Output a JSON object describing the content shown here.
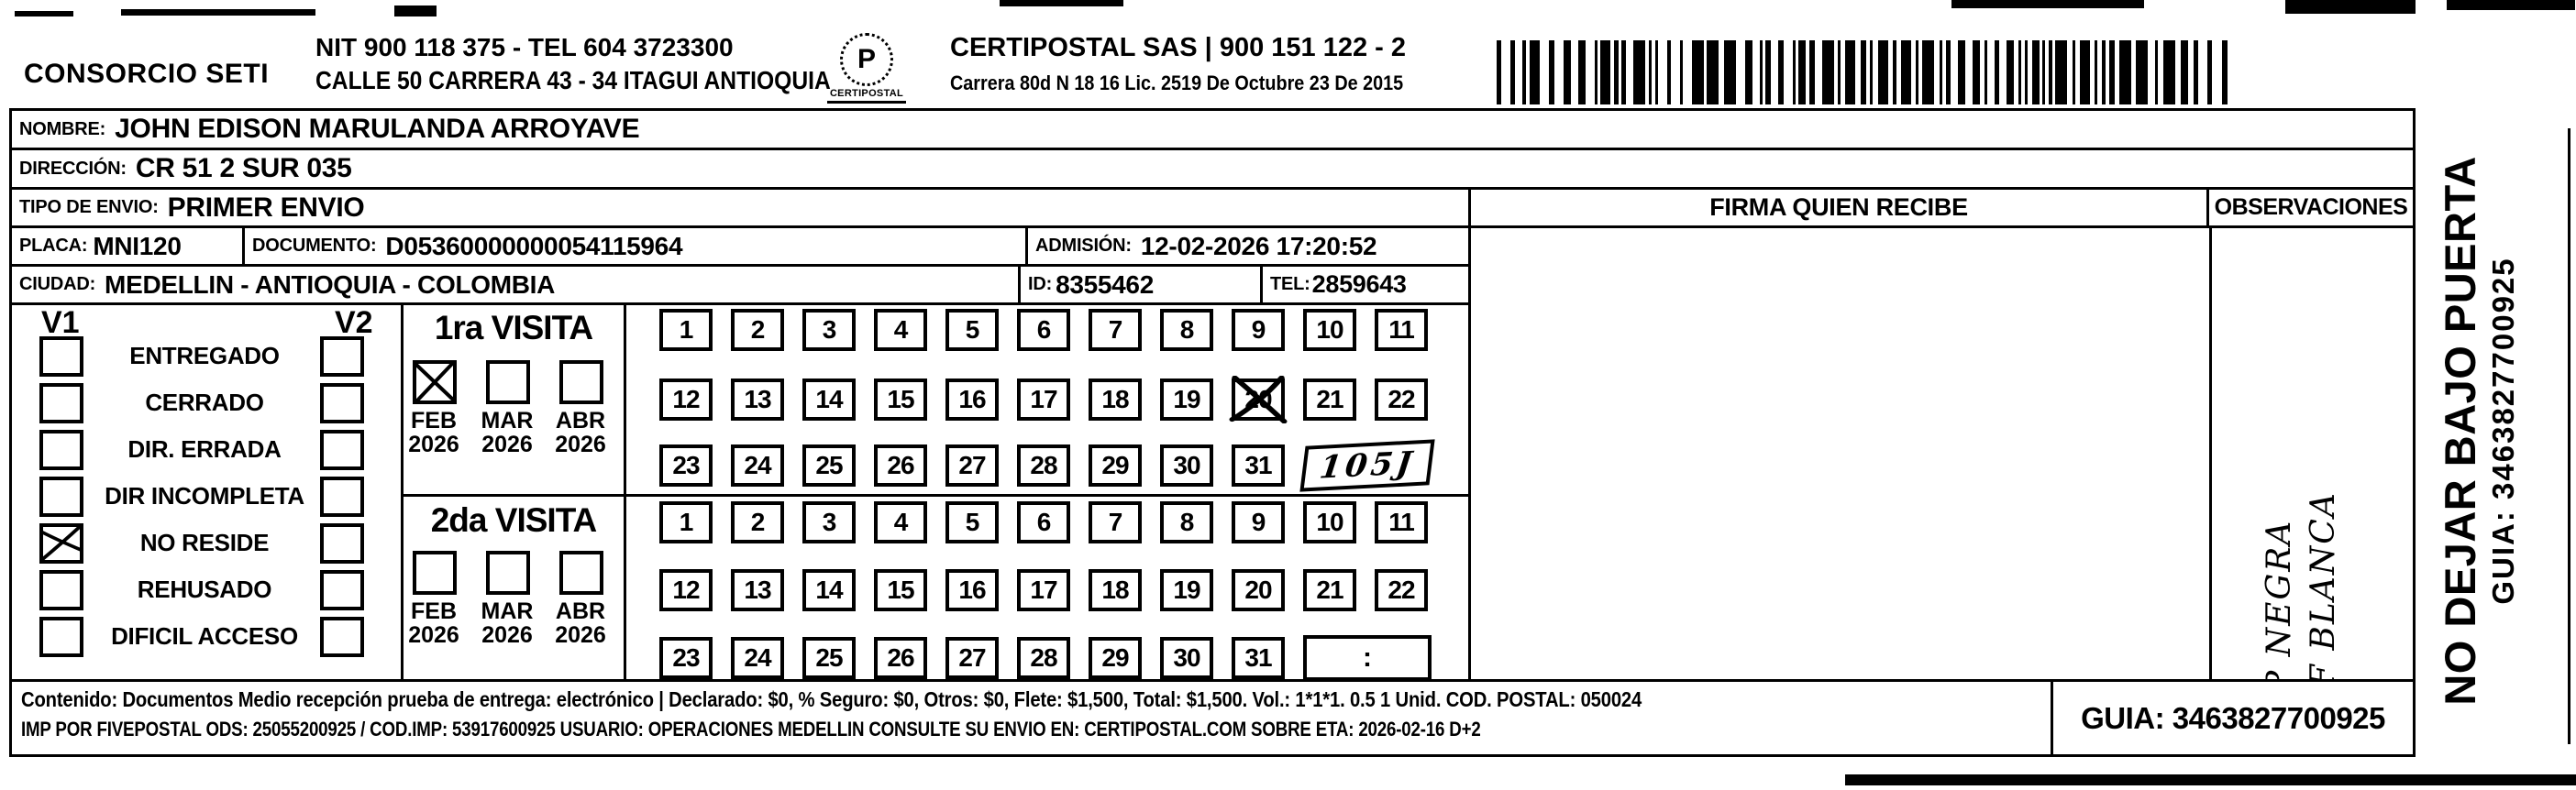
{
  "header": {
    "company": "CONSORCIO SETI",
    "nit_tel": "NIT 900 118 375 - TEL 604 3723300",
    "address": "CALLE 50 CARRERA 43 - 34 ITAGUI ANTIOQUIA",
    "logo": {
      "name": "CERTIPOSTAL",
      "glyph": "P"
    },
    "carrier": "CERTIPOSTAL SAS | 900 151 122 - 2",
    "carrier_address": "Carrera 80d N 18 16  Lic. 2519 De Octubre 23 De 2015"
  },
  "shipment": {
    "nombre_label": "NOMBRE:",
    "nombre": "JOHN EDISON MARULANDA ARROYAVE",
    "direccion_label": "DIRECCIÓN:",
    "direccion": "CR 51 2 SUR 035",
    "tipo_envio_label": "TIPO DE ENVIO:",
    "tipo_envio": "PRIMER ENVIO",
    "placa_label": "PLACA:",
    "placa": "MNI120",
    "documento_label": "DOCUMENTO:",
    "documento": "D05360000000054115964",
    "admision_label": "ADMISIÓN:",
    "admision": "12-02-2026 17:20:52",
    "ciudad_label": "CIUDAD:",
    "ciudad": "MEDELLIN - ANTIOQUIA - COLOMBIA",
    "id_label": "ID:",
    "id": "8355462",
    "tel_label": "TEL:",
    "tel": "2859643"
  },
  "status_panel": {
    "v1": "V1",
    "v2": "V2",
    "options": [
      {
        "label": "ENTREGADO",
        "v1": false,
        "v2": false
      },
      {
        "label": "CERRADO",
        "v1": false,
        "v2": false
      },
      {
        "label": "DIR. ERRADA",
        "v1": false,
        "v2": false
      },
      {
        "label": "DIR INCOMPLETA",
        "v1": false,
        "v2": false
      },
      {
        "label": "NO RESIDE",
        "v1": true,
        "v2": false
      },
      {
        "label": "REHUSADO",
        "v1": false,
        "v2": false
      },
      {
        "label": "DIFICIL ACCESO",
        "v1": false,
        "v2": false
      }
    ]
  },
  "visits": [
    {
      "title": "1ra VISITA",
      "months": [
        {
          "month": "FEB",
          "year": "2026",
          "checked": true
        },
        {
          "month": "MAR",
          "year": "2026",
          "checked": false
        },
        {
          "month": "ABR",
          "year": "2026",
          "checked": false
        }
      ],
      "day_rows": [
        [
          1,
          2,
          3,
          4,
          5,
          6,
          7,
          8,
          9,
          10,
          11
        ],
        [
          12,
          13,
          14,
          15,
          16,
          17,
          18,
          19,
          20,
          21,
          22
        ],
        [
          23,
          24,
          25,
          26,
          27,
          28,
          29,
          30,
          31
        ]
      ],
      "crossed_day": 20,
      "time_box": "105J",
      "time_box_handwritten": true
    },
    {
      "title": "2da VISITA",
      "months": [
        {
          "month": "FEB",
          "year": "2026",
          "checked": false
        },
        {
          "month": "MAR",
          "year": "2026",
          "checked": false
        },
        {
          "month": "ABR",
          "year": "2026",
          "checked": false
        }
      ],
      "day_rows": [
        [
          1,
          2,
          3,
          4,
          5,
          6,
          7,
          8,
          9,
          10,
          11
        ],
        [
          12,
          13,
          14,
          15,
          16,
          17,
          18,
          19,
          20,
          21,
          22
        ],
        [
          23,
          24,
          25,
          26,
          27,
          28,
          29,
          30,
          31
        ]
      ],
      "crossed_day": null,
      "time_box": ":",
      "time_box_handwritten": false
    }
  ],
  "signature": {
    "title": "FIRMA QUIEN RECIBE"
  },
  "observaciones": {
    "title": "OBSERVACIONES",
    "handwriting": [
      "P NEGRA",
      "F BLANCA"
    ]
  },
  "side_note": {
    "warning": "NO DEJAR BAJO PUERTA",
    "guia": "GUIA: 3463827700925"
  },
  "footer": {
    "line1": "Contenido: Documentos Medio recepción prueba de entrega: electrónico | Declarado: $0, % Seguro: $0, Otros: $0, Flete: $1,500, Total: $1,500. Vol.: 1*1*1. 0.5  1 Unid. COD. POSTAL: 050024",
    "line2": "IMP POR FIVEPOSTAL ODS: 25055200925 / COD.IMP: 53917600925 USUARIO: OPERACIONES MEDELLIN CONSULTE SU ENVIO EN: CERTIPOSTAL.COM SOBRE ETA: 2026-02-16 D+2",
    "guia": "GUIA: 3463827700925"
  }
}
